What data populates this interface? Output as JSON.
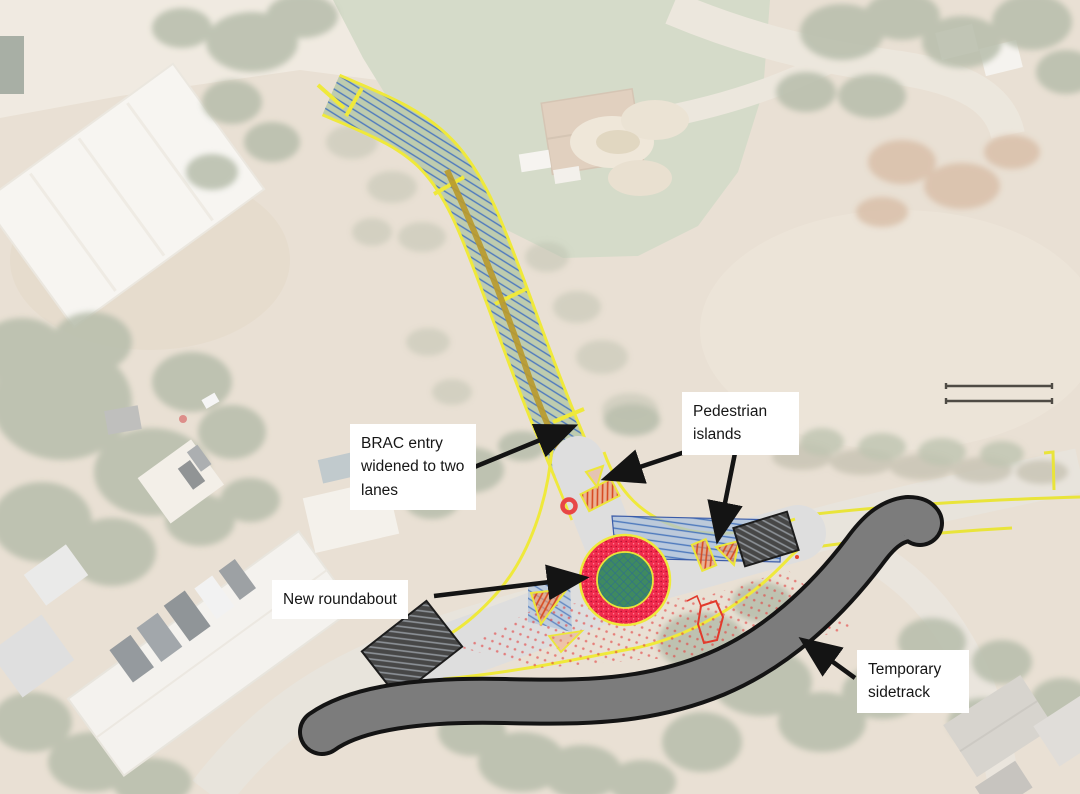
{
  "map": {
    "annotations": {
      "brac_entry": {
        "text": "BRAC entry widened to two lanes"
      },
      "pedestrian_islands": {
        "text": "Pedestrian islands"
      },
      "new_roundabout": {
        "text": "New roundabout"
      },
      "temporary_sidetrack": {
        "text": "Temporary sidetrack"
      }
    },
    "colors": {
      "plan_edge_yellow": "#efe93b",
      "corridor_blue_hatch": "#4d79bd",
      "roundabout_ring_red": "#f02c4d",
      "roundabout_centre_green": "#3f8a60",
      "island_orange": "#d84a20",
      "closure_hatch_dark": "#474747",
      "sidetrack_gray": "#7c7c7c",
      "sidetrack_outline": "#141414",
      "arrow_black": "#141414"
    }
  }
}
